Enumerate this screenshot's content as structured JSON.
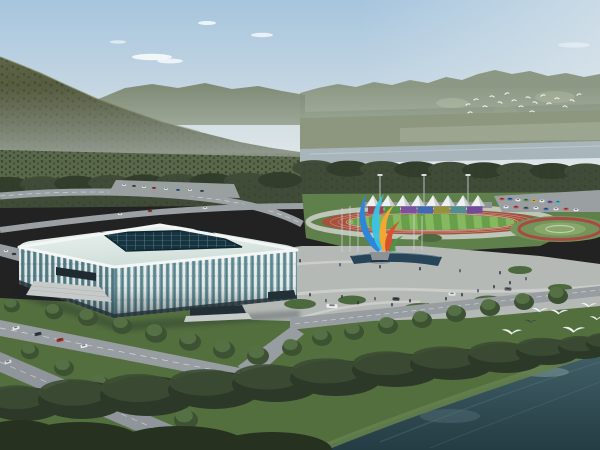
{
  "meta": {
    "description": "Aerial architectural rendering: riverside sports complex with a white lattice indoor arena, outdoor athletics track with white canopy grandstand, colorful plaza sculpture, roads, forests, mountains and flying egrets",
    "no_visible_text": true
  },
  "palette": {
    "sky_top": "#a6c5de",
    "sky_mid": "#c6d7e2",
    "sky_low": "#dfe6e7",
    "cloud": "#f7fbfc",
    "ridge_right": "#8d9884",
    "ridge_right_shadow": "#77836b",
    "ridge_patch": "#a9b096",
    "ridge_left": "#7c8870",
    "mountain_top": "#5f6546",
    "mountain_bottom": "#3d452e",
    "mountain_ridge_light": "#767b52",
    "valley": "#8d9780",
    "fields": "#aab39e",
    "river": "#a8b5bb",
    "river_light": "#c6d0d3",
    "forest": "#404c38",
    "forest_dark": "#323d2b",
    "orchard_base": "#59684a",
    "lawn": "#5f7f4b",
    "grass_fore": "#546f3e",
    "shore_grass": "#64804d",
    "track_red": "#a8503c",
    "lane_line": "#e9e3dd",
    "walk_ring": "#c9cec7",
    "field_green_light": "#84b95f",
    "field_green_dark": "#699f4a",
    "plaza": "#b5b9b5",
    "plaza_path": "#cfd2cf",
    "road": "#979da1",
    "lot": "#9aa0a0",
    "pool": "#274459",
    "roof_light": "#ecf3f0",
    "roof_dark": "#cfdeda",
    "fascia": "#f3f6f5",
    "skylight": "#17333f",
    "skylight_grid": "#5d8894",
    "glass_front": "#6f99a1",
    "glass_left": "#5d868f",
    "rib_white": "#eff4f3",
    "base_dark": "#263238",
    "tent": "#eef1f0",
    "tent_shade": "#c9d0cf",
    "stand": "#8f9597",
    "garden_green": "#74935a",
    "garden_inner": "#87a868",
    "flower_ring": "#a84a42",
    "water_top": "#426068",
    "water_bottom": "#243c44",
    "water_streak": "#5d7a82",
    "water_light": "#8fa7a6",
    "tree_dark": "#2c3828",
    "tree_mid": "#3c4c33",
    "tree_street": "#3d5232",
    "tree_street_light": "#567246",
    "people": [
      "#2e3744",
      "#4a5a68",
      "#30404c"
    ],
    "bird_white": "#ffffff",
    "bird_dark": "#39434a",
    "sculpture_blue": "#2e86d8",
    "sculpture_cyan": "#38c4e8",
    "sculpture_yellow": "#f0a832",
    "sculpture_orange": "#d8502e",
    "sculpture_green": "#4f9247",
    "pedestal": "#8d9296"
  },
  "sky": {
    "clouds": [
      {
        "x": 152,
        "y": 57,
        "rx": 20,
        "ry": 3.2,
        "o": 0.9
      },
      {
        "x": 170,
        "y": 61,
        "rx": 13,
        "ry": 2.4,
        "o": 0.8
      },
      {
        "x": 207,
        "y": 23,
        "rx": 9,
        "ry": 2.0,
        "o": 0.85
      },
      {
        "x": 262,
        "y": 35,
        "rx": 11,
        "ry": 2.2,
        "o": 0.8
      },
      {
        "x": 118,
        "y": 42,
        "rx": 8,
        "ry": 1.8,
        "o": 0.6
      },
      {
        "x": 574,
        "y": 45,
        "rx": 16,
        "ry": 2.6,
        "o": 0.45
      }
    ]
  },
  "scene": {
    "tents": {
      "count": 8,
      "x0": 366,
      "dx": 15,
      "w": 14,
      "baseY": 206,
      "h": 11
    },
    "banners": {
      "x0": 368,
      "y": 206.5,
      "w": 16.5,
      "h": 7,
      "colors": [
        "#9a4550",
        "#4f9247",
        "#7c4fa0",
        "#3f68b5",
        "#93923d",
        "#4f8f8f",
        "#714b9b"
      ]
    },
    "floodlights": [
      380,
      424,
      468
    ],
    "flagpoles": [
      [
        342,
        252,
        208
      ],
      [
        350,
        252,
        206
      ],
      [
        358,
        252,
        210
      ],
      [
        414,
        250,
        214
      ],
      [
        422,
        250,
        216
      ]
    ],
    "parkingCars": [
      [
        502,
        199,
        "#cf4a3a"
      ],
      [
        510,
        199,
        "#3f68b5"
      ],
      [
        518,
        200,
        "#e8e8e8"
      ],
      [
        526,
        200,
        "#4f9247"
      ],
      [
        534,
        201,
        "#d8a23a"
      ],
      [
        542,
        201,
        "#e8e8e8"
      ],
      [
        550,
        202,
        "#7c4fa0"
      ],
      [
        558,
        202,
        "#38b0c8"
      ],
      [
        506,
        207,
        "#e8e8e8"
      ],
      [
        516,
        207,
        "#b04a52"
      ],
      [
        526,
        208,
        "#5a6066"
      ],
      [
        536,
        208,
        "#e8e8e8"
      ],
      [
        546,
        209,
        "#3f68b5"
      ],
      [
        556,
        209,
        "#e8e8e8"
      ],
      [
        566,
        209,
        "#cf4a3a"
      ],
      [
        576,
        210,
        "#e8e8e8"
      ]
    ],
    "lotCars": [
      [
        124,
        185,
        "#d8dcdc"
      ],
      [
        134,
        186,
        "#45505a"
      ],
      [
        144,
        187,
        "#d8dcdc"
      ],
      [
        154,
        188,
        "#8c3a30"
      ],
      [
        166,
        189,
        "#d8dcdc"
      ],
      [
        178,
        190,
        "#3a5a88"
      ],
      [
        190,
        190,
        "#d8dcdc"
      ],
      [
        202,
        191,
        "#45505a"
      ]
    ],
    "roadCars": [
      [
        16,
        328,
        -14,
        "#e6e9ea",
        7,
        3.2
      ],
      [
        38,
        334,
        -14,
        "#33383f",
        7,
        3.2
      ],
      [
        60,
        340,
        -14,
        "#a03228",
        7,
        3.2
      ],
      [
        84,
        346,
        -14,
        "#e6e9ea",
        7,
        3.2
      ],
      [
        8,
        362,
        -18,
        "#d9dde0",
        7,
        3.2
      ],
      [
        70,
        382,
        -18,
        "#8c2b26",
        7,
        3.2
      ],
      [
        118,
        398,
        -18,
        "#2f343a",
        7,
        3.2
      ],
      [
        332,
        306,
        3,
        "#eceeee",
        11,
        4
      ],
      [
        396,
        299,
        3,
        "#3a4047",
        7,
        3.2
      ],
      [
        452,
        294,
        3,
        "#e6e9ea",
        7,
        3.2
      ],
      [
        508,
        289,
        3,
        "#5a6066",
        7,
        3.2
      ]
    ],
    "smallRoadCars": [
      [
        6,
        251,
        "#d8dcdc"
      ],
      [
        14,
        254,
        "#3a4048"
      ],
      [
        120,
        214,
        "#d8dcdc"
      ],
      [
        150,
        211,
        "#8c3a30"
      ],
      [
        205,
        208,
        "#d8dcdc"
      ]
    ],
    "shrubs": [
      [
        262,
        288,
        14,
        5
      ],
      [
        300,
        304,
        16,
        5
      ],
      [
        352,
        300,
        14,
        4.5
      ],
      [
        420,
        308,
        16,
        5
      ],
      [
        488,
        300,
        14,
        4.5
      ],
      [
        262,
        258,
        10,
        4
      ],
      [
        430,
        238,
        12,
        4
      ],
      [
        520,
        270,
        12,
        4
      ],
      [
        560,
        288,
        12,
        4
      ]
    ],
    "people": [
      [
        266,
        292
      ],
      [
        280,
        298
      ],
      [
        295,
        288
      ],
      [
        310,
        296
      ],
      [
        326,
        302
      ],
      [
        342,
        298
      ],
      [
        358,
        304
      ],
      [
        375,
        300
      ],
      [
        392,
        306
      ],
      [
        410,
        302
      ],
      [
        428,
        306
      ],
      [
        446,
        300
      ],
      [
        462,
        296
      ],
      [
        478,
        292
      ],
      [
        494,
        288
      ],
      [
        510,
        284
      ],
      [
        526,
        280
      ],
      [
        258,
        270
      ],
      [
        300,
        262
      ],
      [
        340,
        266
      ],
      [
        380,
        268
      ],
      [
        420,
        270
      ],
      [
        460,
        272
      ],
      [
        500,
        274
      ],
      [
        205,
        316
      ],
      [
        218,
        318
      ],
      [
        236,
        314
      ],
      [
        46,
        295
      ],
      [
        54,
        292
      ]
    ],
    "streetTrees": [
      [
        54,
        312,
        9
      ],
      [
        88,
        318,
        10
      ],
      [
        122,
        326,
        10
      ],
      [
        156,
        334,
        11
      ],
      [
        190,
        342,
        11
      ],
      [
        224,
        350,
        11
      ],
      [
        258,
        356,
        11
      ],
      [
        292,
        348,
        10
      ],
      [
        322,
        338,
        10
      ],
      [
        354,
        332,
        10
      ],
      [
        388,
        326,
        10
      ],
      [
        422,
        320,
        10
      ],
      [
        456,
        314,
        10
      ],
      [
        490,
        308,
        10
      ],
      [
        524,
        302,
        10
      ],
      [
        558,
        296,
        10
      ],
      [
        12,
        306,
        8
      ],
      [
        30,
        352,
        9
      ],
      [
        64,
        368,
        10
      ],
      [
        100,
        384,
        10
      ],
      [
        140,
        400,
        11
      ],
      [
        186,
        420,
        12
      ]
    ],
    "shoreTrees": [
      [
        24,
        404,
        40,
        17
      ],
      [
        82,
        400,
        44,
        19
      ],
      [
        148,
        396,
        48,
        20
      ],
      [
        214,
        390,
        46,
        19
      ],
      [
        276,
        384,
        44,
        18
      ],
      [
        336,
        378,
        46,
        18
      ],
      [
        396,
        370,
        44,
        17
      ],
      [
        452,
        364,
        42,
        16
      ],
      [
        506,
        358,
        38,
        15
      ],
      [
        548,
        352,
        32,
        13
      ],
      [
        584,
        348,
        26,
        11
      ],
      [
        608,
        344,
        22,
        10
      ]
    ],
    "bottomTrees": [
      [
        80,
        442,
        62,
        20
      ],
      [
        180,
        448,
        70,
        22
      ],
      [
        272,
        450,
        60,
        18
      ],
      [
        20,
        436,
        40,
        16
      ]
    ],
    "birdsFar": [
      [
        468,
        105
      ],
      [
        476,
        100
      ],
      [
        485,
        107
      ],
      [
        492,
        97
      ],
      [
        500,
        103
      ],
      [
        507,
        94
      ],
      [
        514,
        101
      ],
      [
        521,
        107
      ],
      [
        528,
        98
      ],
      [
        535,
        103
      ],
      [
        543,
        96
      ],
      [
        549,
        104
      ],
      [
        557,
        99
      ],
      [
        565,
        107
      ],
      [
        572,
        101
      ],
      [
        579,
        95
      ],
      [
        470,
        113
      ],
      [
        532,
        112
      ]
    ],
    "birdsNear": [
      [
        512,
        333,
        10
      ],
      [
        540,
        311,
        8
      ],
      [
        559,
        313,
        9
      ],
      [
        574,
        331,
        11
      ],
      [
        589,
        306,
        8
      ],
      [
        597,
        319,
        7
      ]
    ],
    "birdDark": [
      531,
      322,
      6
    ]
  }
}
